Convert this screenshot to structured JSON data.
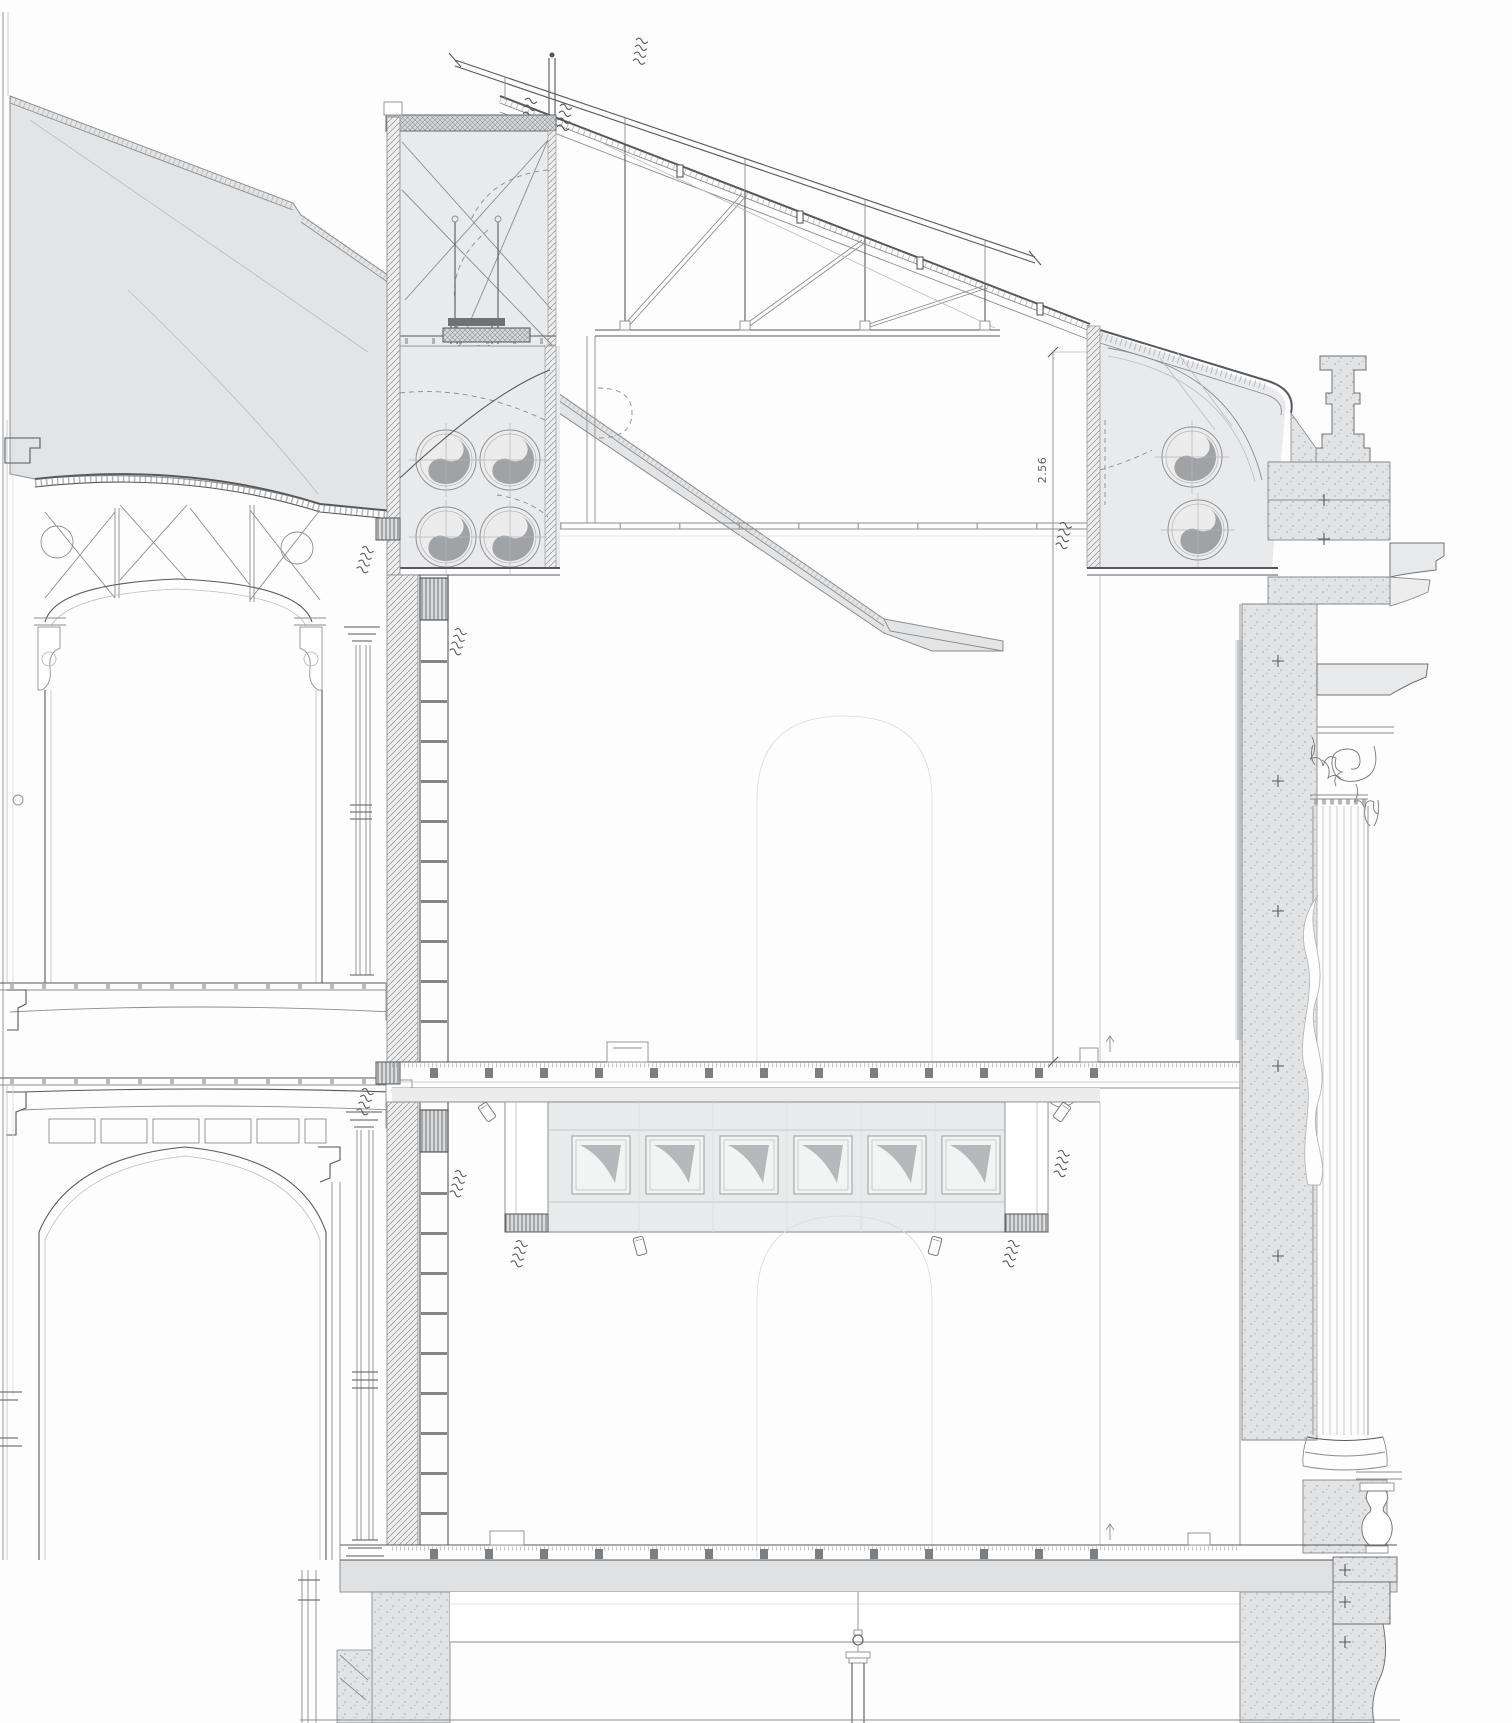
{
  "drawing": {
    "type": "architectural cross-section",
    "annotations": {
      "height_dimension": "2.56"
    },
    "palette": {
      "line_dark": "#55585c",
      "line_mid": "#8a8d90",
      "line_light": "#b9bcbe",
      "line_faint": "#d9dbdc",
      "fill_roof": "#e3e4e5",
      "fill_room": "#e9eaeb",
      "fill_slab": "#e0e1e3",
      "fill_stipple": "#e2e3e5",
      "fill_blade": "#9fa3a6",
      "fill_wedge": "#abaeb1",
      "fill_dark": "#707376",
      "paper": "#fdfdfd"
    },
    "features": {
      "left_fan_room_fans": 4,
      "right_fan_room_fans": 2,
      "skylight_frames": 6,
      "roof_truss_posts": 4,
      "storeys_shown": 3
    }
  }
}
